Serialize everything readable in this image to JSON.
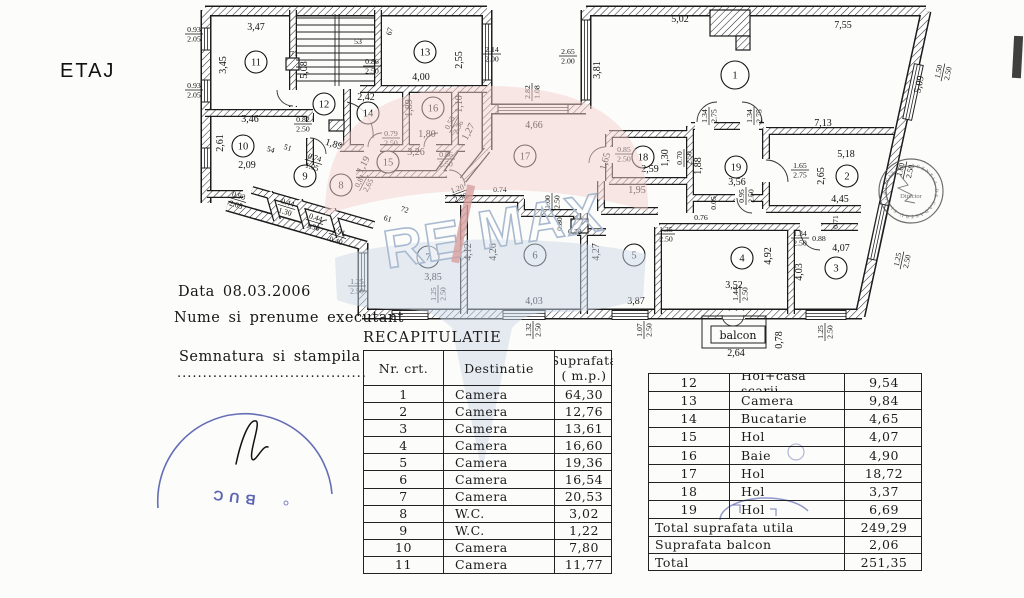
{
  "page": {
    "label": "ETAJ"
  },
  "meta": {
    "date_line": "Data 08.03.2006",
    "executant_line": "Nume si prenume executant",
    "signature_line": "Semnatura si stampila",
    "signature_dots": "....................................."
  },
  "recap_table": {
    "title": "RECAPITULATIE",
    "headers": {
      "col1": "Nr. crt.",
      "col2": "Destinatie",
      "col3a": "Suprafata",
      "col3b": "( m.p.)"
    },
    "rows": [
      {
        "nr": "1",
        "dest": "Camera",
        "sup": "64,30"
      },
      {
        "nr": "2",
        "dest": "Camera",
        "sup": "12,76"
      },
      {
        "nr": "3",
        "dest": "Camera",
        "sup": "13,61"
      },
      {
        "nr": "4",
        "dest": "Camera",
        "sup": "16,60"
      },
      {
        "nr": "5",
        "dest": "Camera",
        "sup": "19,36"
      },
      {
        "nr": "6",
        "dest": "Camera",
        "sup": "16,54"
      },
      {
        "nr": "7",
        "dest": "Camera",
        "sup": "20,53"
      },
      {
        "nr": "8",
        "dest": "W.C.",
        "sup": "3,02"
      },
      {
        "nr": "9",
        "dest": "W.C.",
        "sup": "1,22"
      },
      {
        "nr": "10",
        "dest": "Camera",
        "sup": "7,80"
      },
      {
        "nr": "11",
        "dest": "Camera",
        "sup": "11,77"
      }
    ]
  },
  "annex_table": {
    "rows": [
      {
        "nr": "12",
        "dest": "Hol+casa scarii",
        "sup": "9,54"
      },
      {
        "nr": "13",
        "dest": "Camera",
        "sup": "9,84"
      },
      {
        "nr": "14",
        "dest": "Bucatarie",
        "sup": "4,65"
      },
      {
        "nr": "15",
        "dest": "Hol",
        "sup": "4,07"
      },
      {
        "nr": "16",
        "dest": "Baie",
        "sup": "4,90"
      },
      {
        "nr": "17",
        "dest": "Hol",
        "sup": "18,72"
      },
      {
        "nr": "18",
        "dest": "Hol",
        "sup": "3,37"
      },
      {
        "nr": "19",
        "dest": "Hol",
        "sup": "6,69"
      }
    ],
    "totals": [
      {
        "label": "Total suprafata utila",
        "value": "249,29"
      },
      {
        "label": "Suprafata balcon",
        "value": "2,06"
      },
      {
        "label": "Total",
        "value": "251,35"
      }
    ]
  },
  "floor_plan": {
    "balcony_label": "balcon",
    "rooms": [
      {
        "id": "1",
        "x": 735,
        "y": 75,
        "r": 14
      },
      {
        "id": "2",
        "x": 847,
        "y": 176
      },
      {
        "id": "3",
        "x": 836,
        "y": 268
      },
      {
        "id": "4",
        "x": 742,
        "y": 258
      },
      {
        "id": "5",
        "x": 634,
        "y": 255
      },
      {
        "id": "6",
        "x": 535,
        "y": 255
      },
      {
        "id": "7",
        "x": 428,
        "y": 257
      },
      {
        "id": "8",
        "x": 341,
        "y": 185
      },
      {
        "id": "9",
        "x": 305,
        "y": 176
      },
      {
        "id": "10",
        "x": 243,
        "y": 146
      },
      {
        "id": "11",
        "x": 256,
        "y": 62
      },
      {
        "id": "12",
        "x": 324,
        "y": 104
      },
      {
        "id": "13",
        "x": 425,
        "y": 52
      },
      {
        "id": "14",
        "x": 368,
        "y": 113
      },
      {
        "id": "15",
        "x": 388,
        "y": 162
      },
      {
        "id": "16",
        "x": 433,
        "y": 108
      },
      {
        "id": "17",
        "x": 525,
        "y": 156
      },
      {
        "id": "18",
        "x": 643,
        "y": 157
      },
      {
        "id": "19",
        "x": 736,
        "y": 167
      }
    ],
    "dims": [
      {
        "t": "3,47",
        "x": 256,
        "y": 30
      },
      {
        "t": "0.93",
        "b": "2.05",
        "x": 194,
        "y": 32
      },
      {
        "t": "3,45",
        "x": 226,
        "y": 65,
        "r": -90
      },
      {
        "t": "0.93",
        "b": "2.05",
        "x": 194,
        "y": 88
      },
      {
        "t": "71",
        "x": 294,
        "y": 56,
        "fs": 1
      },
      {
        "t": "5,08",
        "x": 307,
        "y": 70,
        "r": -90
      },
      {
        "t": "53",
        "x": 358,
        "y": 44,
        "fs": 1
      },
      {
        "t": "67",
        "x": 392,
        "y": 32,
        "fs": 1,
        "r": -75
      },
      {
        "t": "2,55",
        "x": 462,
        "y": 60,
        "r": -90
      },
      {
        "t": "4,00",
        "x": 421,
        "y": 80
      },
      {
        "t": "0.86",
        "b": "2.50",
        "x": 372,
        "y": 64
      },
      {
        "t": "2.14",
        "b": "2.00",
        "x": 492,
        "y": 52
      },
      {
        "t": "2.65",
        "b": "2.00",
        "x": 568,
        "y": 54
      },
      {
        "t": "3,81",
        "x": 600,
        "y": 70,
        "r": -90
      },
      {
        "t": "2.82",
        "b": "1.08",
        "x": 530,
        "y": 92,
        "r": -90
      },
      {
        "t": "4,66",
        "x": 534,
        "y": 128
      },
      {
        "t": "5,02",
        "x": 680,
        "y": 22
      },
      {
        "t": "7,55",
        "x": 843,
        "y": 28
      },
      {
        "t": "5,09",
        "x": 922,
        "y": 85,
        "r": -78
      },
      {
        "t": "1.50",
        "b": "2.50",
        "x": 941,
        "y": 72,
        "r": -78,
        "fs": 1
      },
      {
        "t": "7,13",
        "x": 823,
        "y": 126
      },
      {
        "t": "2,42",
        "x": 366,
        "y": 100
      },
      {
        "t": "1,89",
        "x": 412,
        "y": 108,
        "r": -90
      },
      {
        "t": "1,10",
        "x": 462,
        "y": 104,
        "r": -90
      },
      {
        "t": "1,80",
        "x": 427,
        "y": 137
      },
      {
        "t": "0.55",
        "b": "2.36",
        "x": 452,
        "y": 124,
        "r": -62,
        "fs": 1
      },
      {
        "t": "1,27",
        "x": 471,
        "y": 133,
        "r": -62
      },
      {
        "t": "0.79",
        "b": "2.50",
        "x": 391,
        "y": 136,
        "fs": 1
      },
      {
        "t": "3,46",
        "x": 250,
        "y": 122
      },
      {
        "t": "0.82",
        "b": "2.50",
        "x": 303,
        "y": 122,
        "fs": 1
      },
      {
        "t": "2,61",
        "x": 223,
        "y": 143,
        "r": -90
      },
      {
        "t": "2,09",
        "x": 247,
        "y": 168
      },
      {
        "t": "1,89",
        "x": 333,
        "y": 147,
        "r": 17
      },
      {
        "t": "54",
        "x": 270,
        "y": 152,
        "fs": 1,
        "r": 17
      },
      {
        "t": "51",
        "x": 287,
        "y": 150,
        "fs": 1,
        "r": 17
      },
      {
        "t": "3,26",
        "x": 416,
        "y": 155
      },
      {
        "t": "0.86",
        "b": "2.50",
        "x": 446,
        "y": 157,
        "fs": 1
      },
      {
        "t": "1,19",
        "x": 366,
        "y": 166,
        "r": -62
      },
      {
        "t": "0.74",
        "b": "1.95",
        "x": 314,
        "y": 160,
        "r": 17,
        "fs": 1
      },
      {
        "t": "0,81",
        "b": "2,65",
        "x": 362,
        "y": 182,
        "r": -62,
        "fs": 1
      },
      {
        "t": "1.20",
        "b": "2.50",
        "x": 458,
        "y": 191,
        "r": -20,
        "fs": 1
      },
      {
        "t": "0.93",
        "b": "2.05",
        "x": 238,
        "y": 198,
        "r": 17,
        "fs": 1
      },
      {
        "t": "0.44",
        "b": "1.30",
        "x": 287,
        "y": 205,
        "r": 17,
        "fs": 1
      },
      {
        "t": "0.44",
        "b": "1.30",
        "x": 315,
        "y": 220,
        "r": 17,
        "fs": 1
      },
      {
        "t": "1.91",
        "b": "0.40",
        "x": 338,
        "y": 234,
        "r": 17,
        "fs": 1
      },
      {
        "t": "72",
        "x": 404,
        "y": 212,
        "fs": 1,
        "r": 17
      },
      {
        "t": "61",
        "x": 387,
        "y": 221,
        "fs": 1,
        "r": 17
      },
      {
        "t": "0.74",
        "x": 500,
        "y": 192,
        "fs": 1
      },
      {
        "t": "1.00",
        "b": "2.50",
        "x": 550,
        "y": 202,
        "r": -90,
        "fs": 1
      },
      {
        "t": "0.80",
        "x": 562,
        "y": 224,
        "r": -90,
        "fs": 1
      },
      {
        "t": "0.78",
        "x": 575,
        "y": 234,
        "fs": 1
      },
      {
        "t": "1,65",
        "x": 608,
        "y": 162,
        "r": -75
      },
      {
        "t": "0.85",
        "b": "2.50",
        "x": 624,
        "y": 152,
        "fs": 1
      },
      {
        "t": "2,59",
        "x": 650,
        "y": 172
      },
      {
        "t": "1,30",
        "x": 668,
        "y": 158,
        "r": -90
      },
      {
        "t": "0.70",
        "b": "2.50",
        "x": 682,
        "y": 158,
        "r": -90,
        "fs": 1
      },
      {
        "t": "1,88",
        "x": 701,
        "y": 166,
        "r": -90
      },
      {
        "t": "1.34",
        "b": "2.75",
        "x": 707,
        "y": 116,
        "r": -90,
        "fs": 1
      },
      {
        "t": "1.34",
        "b": "2.75",
        "x": 752,
        "y": 116,
        "r": -90,
        "fs": 1
      },
      {
        "t": "1,95",
        "x": 637,
        "y": 193
      },
      {
        "t": "3,56",
        "x": 737,
        "y": 185
      },
      {
        "t": "0.05",
        "x": 716,
        "y": 203,
        "r": -90,
        "fs": 1
      },
      {
        "t": "0.95",
        "b": "2.50",
        "x": 744,
        "y": 196,
        "r": -90,
        "fs": 1
      },
      {
        "t": "0.76",
        "x": 701,
        "y": 220,
        "fs": 1
      },
      {
        "t": "1.35",
        "b": "2.50",
        "x": 666,
        "y": 232,
        "fs": 1
      },
      {
        "t": "5,18",
        "x": 846,
        "y": 157
      },
      {
        "t": "2,65",
        "x": 824,
        "y": 176,
        "r": -90
      },
      {
        "t": "1.65",
        "b": "2.75",
        "x": 800,
        "y": 168,
        "fs": 1
      },
      {
        "t": "4,45",
        "x": 840,
        "y": 202
      },
      {
        "t": "0.71",
        "x": 838,
        "y": 222,
        "r": -90,
        "fs": 1
      },
      {
        "t": "0.88",
        "x": 819,
        "y": 241,
        "fs": 1
      },
      {
        "t": "1.34",
        "b": "2.50",
        "x": 800,
        "y": 236,
        "fs": 1
      },
      {
        "t": "4,07",
        "x": 841,
        "y": 251
      },
      {
        "t": "1.25",
        "b": "2.50",
        "x": 900,
        "y": 260,
        "r": -78,
        "fs": 1
      },
      {
        "t": "4,03",
        "x": 802,
        "y": 272,
        "r": -90
      },
      {
        "t": "1.60",
        "b": "2.50",
        "x": 903,
        "y": 170,
        "r": -78,
        "fs": 1
      },
      {
        "t": "4,92",
        "x": 771,
        "y": 256,
        "r": -90
      },
      {
        "t": "3,52",
        "x": 734,
        "y": 288
      },
      {
        "t": "1.44",
        "b": "2.50",
        "x": 738,
        "y": 294,
        "r": -90,
        "fs": 1
      },
      {
        "t": "2,64",
        "x": 736,
        "y": 356
      },
      {
        "t": "0,78",
        "x": 782,
        "y": 340,
        "r": -90
      },
      {
        "t": "1.25",
        "b": "2.50",
        "x": 823,
        "y": 332,
        "r": -90,
        "fs": 1
      },
      {
        "t": "4,27",
        "x": 599,
        "y": 252,
        "r": -90
      },
      {
        "t": "3,87",
        "x": 636,
        "y": 304
      },
      {
        "t": "1.07",
        "b": "2.50",
        "x": 642,
        "y": 330,
        "r": -90,
        "fs": 1
      },
      {
        "t": "4,26",
        "x": 496,
        "y": 252,
        "r": -90
      },
      {
        "t": "4,03",
        "x": 534,
        "y": 304
      },
      {
        "t": "1.32",
        "b": "2.50",
        "x": 531,
        "y": 330,
        "r": -90,
        "fs": 1
      },
      {
        "t": "4,12",
        "x": 471,
        "y": 252,
        "r": -90
      },
      {
        "t": "3,85",
        "x": 433,
        "y": 280
      },
      {
        "t": "1.25",
        "b": "2.50",
        "x": 436,
        "y": 294,
        "r": -90,
        "fs": 1
      },
      {
        "t": "1.25",
        "b": "2.50",
        "x": 357,
        "y": 284,
        "fs": 1
      }
    ]
  },
  "watermark": {
    "left": "RE",
    "right": "MAX"
  },
  "stamps": {
    "ring_text": "AGENTIA DE CADASTRU SI PUBLICITATE IMOBILIARA",
    "center_text": "Director",
    "blue_text": "BUC"
  }
}
